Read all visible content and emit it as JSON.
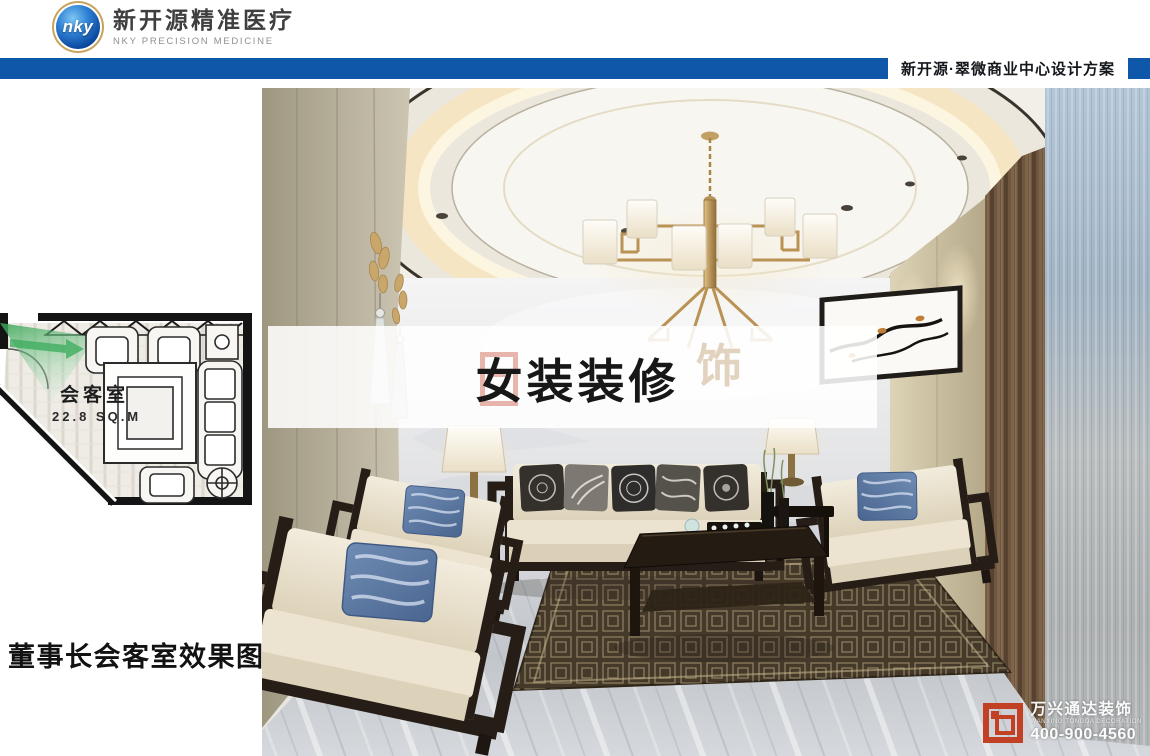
{
  "header": {
    "logo_monogram": "nky",
    "brand_cn": "新开源精准医疗",
    "brand_en": "NKY PRECISION MEDICINE"
  },
  "title_bar": {
    "project_title": "新开源·翠微商业中心设计方案"
  },
  "floorplan": {
    "room_name": "会客室",
    "room_area": "22.8 SQ.M"
  },
  "caption": "董事长会客室效果图",
  "overlay": {
    "headline": "女装装修",
    "watermark_glyph": "饰"
  },
  "vendor": {
    "name_cn": "万兴通达装饰",
    "name_en": "WANXING TONGDA DECORATION",
    "phone": "400-900-4560"
  },
  "colors": {
    "bar_blue": "#0f57a8",
    "logo_blue": "#0c4aa0",
    "logo_gold_ring": "#c9a35c",
    "camera_green": "#35a554",
    "vendor_red": "#c23a1c",
    "wall_beige": "#c6c0ae",
    "curtain_brown": "#6e5640",
    "sheer_blue": "#a9bdd0",
    "rug_brown": "#45392a",
    "pillow_blue": "#5d7ba6"
  }
}
